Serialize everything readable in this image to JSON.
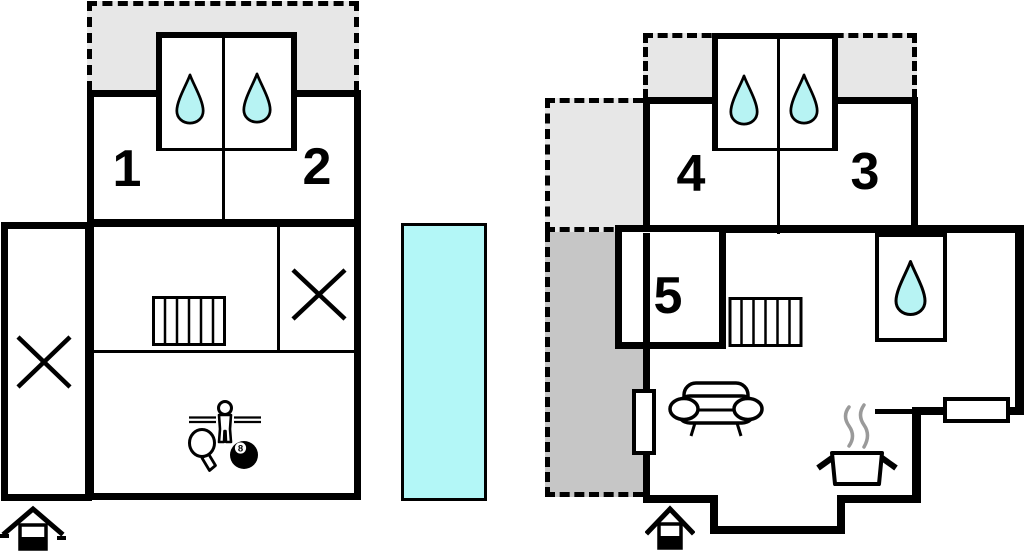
{
  "canvas": {
    "width": 1024,
    "height": 551
  },
  "colors": {
    "background": "#ffffff",
    "wall": "#000000",
    "water": "#b7f3f3",
    "pool": "#b3f7f7",
    "terrace_light": "#e7e7e7",
    "terrace_dark": "#c6c6c6",
    "steam": "#9a9a9a"
  },
  "plans": {
    "left": {
      "rooms": [
        {
          "label": "1",
          "type": "bedroom"
        },
        {
          "label": "2",
          "type": "bedroom"
        }
      ],
      "icons": [
        "water-drop-icon",
        "water-drop-icon",
        "stairs-icon",
        "cross-mark-icon",
        "cross-mark-icon",
        "game-room-icon",
        "entrance-house-icon"
      ]
    },
    "right": {
      "rooms": [
        {
          "label": "4",
          "type": "bedroom"
        },
        {
          "label": "3",
          "type": "bedroom"
        },
        {
          "label": "5",
          "type": "bedroom"
        }
      ],
      "icons": [
        "water-drop-icon",
        "water-drop-icon",
        "water-drop-icon",
        "stairs-icon",
        "sofa-icon",
        "cooking-pot-icon",
        "radiator",
        "radiator",
        "entrance-house-icon",
        "terrace-dashed-area"
      ]
    }
  },
  "pool": {
    "shape": "rectangle",
    "fill": "cyan"
  },
  "game": {
    "billiard_ball_number": "8"
  }
}
